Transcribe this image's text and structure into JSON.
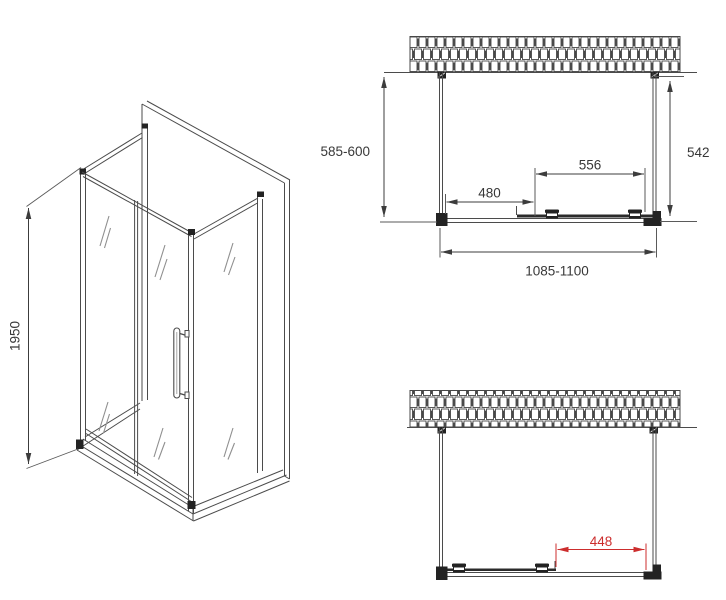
{
  "drawing": {
    "isometric": {
      "height_label": "1950"
    },
    "plan_top": {
      "left_side_depth": "585-600",
      "right_side_depth": "542",
      "fixed_panel_width": "480",
      "door_panel_width": "556",
      "overall_width": "1085-1100"
    },
    "plan_open": {
      "opening_width": "448"
    },
    "colors": {
      "line": "#4b4b4b",
      "dark_fittings": "#232323",
      "dimension_text": "#383838",
      "accent_red": "#cc2d2d",
      "background": "#ffffff"
    }
  }
}
